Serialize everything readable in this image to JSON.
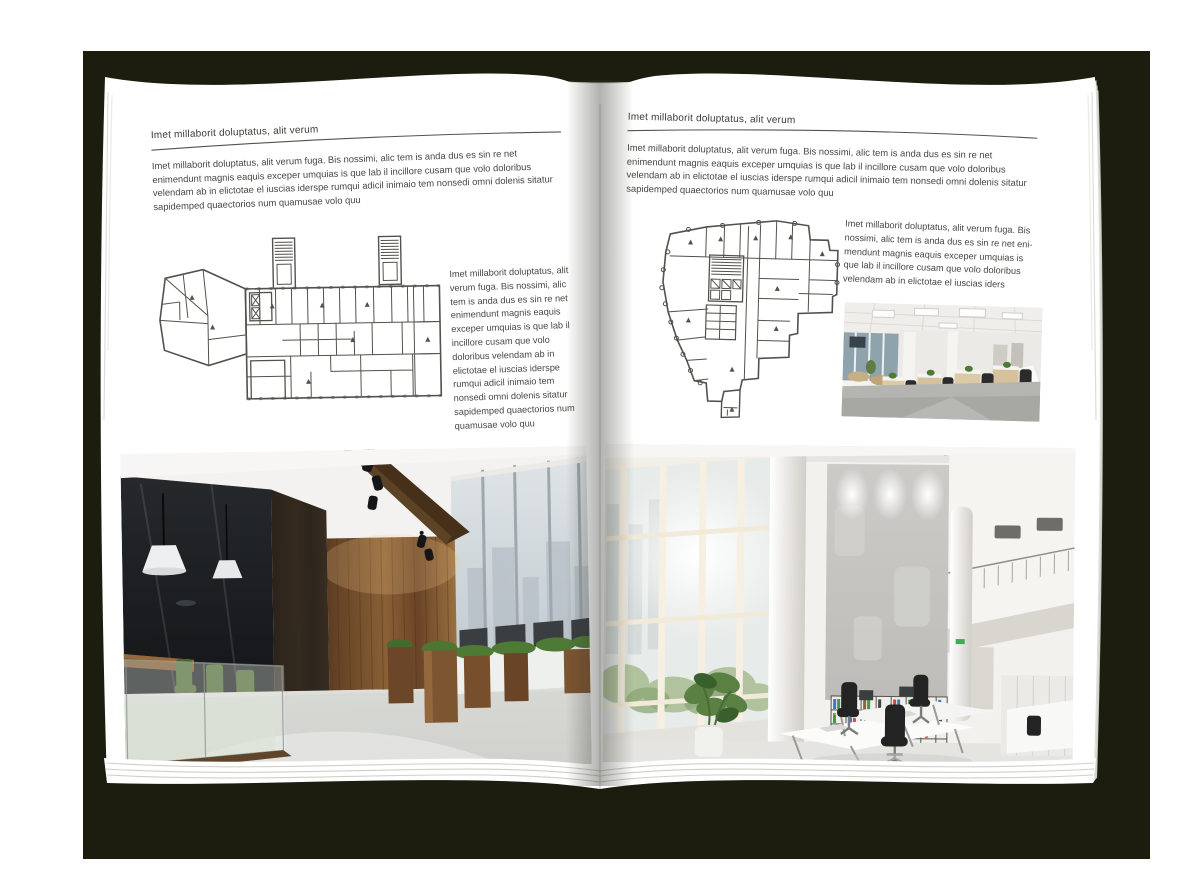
{
  "scene": {
    "kind": "open-magazine-spread-mockup",
    "backdrop_color": "#1c1d0e",
    "page_color": "#ffffff"
  },
  "left_page": {
    "header_title": "Imet millaborit doluptatus, alit verum",
    "intro_paragraph": "Imet millaborit doluptatus, alit verum fuga. Bis nossimi, alic tem is anda dus es sin re net enimendunt magnis eaquis exceper umquias is que lab il incillore cusam que volo doloribus velendam ab in elictotae el iuscias iderspe rumqui adicil inimaio tem nonsedi omni dolenis sitatur sapidemped quaectorios num quamusae volo quu",
    "side_paragraph": "Imet millaborit doluptatus, alit verum fuga. Bis nossimi, alic tem is anda dus es sin re net enimendunt magnis eaquis exceper umquias is que lab il incillore cusam que volo doloribus velendam ab in elictotae el iuscias iderspe rumqui adicil inimaio tem nonsedi omni dolenis sitatur sapidemped quaectorios num quamusae volo quu",
    "floorplan_label": "wide-slab-building-floor-plan-drawing",
    "photo_label": "loft-office-photo-dark-glass-meeting-room-wood-wall"
  },
  "right_page": {
    "header_title": "Imet millaborit doluptatus, alit verum",
    "intro_paragraph": "Imet millaborit doluptatus, alit verum fuga. Bis nossimi, alic tem is anda dus es sin re net enimendunt magnis eaquis exceper umquias is que lab il incillore cusam que volo doloribus velendam ab in elictotae el iuscias iderspe rumqui adicil inimaio tem nonsedi omni dolenis sitatur sapidemped quaectorios num quamusae volo quu",
    "side_paragraph": "Imet millaborit doluptatus, alit verum fuga. Bis nossimi, alic tem is anda dus es sin re net eni-mendunt magnis eaquis exceper umquias is que lab il incillore cusam que volo doloribus velendam ab in elictotae el iuscias iders",
    "floorplan_label": "irregular-tower-floor-plan-drawing",
    "small_photo_label": "open-plan-office-desk-rows-photo",
    "photo_label": "bright-atrium-office-glass-facade-photo"
  }
}
